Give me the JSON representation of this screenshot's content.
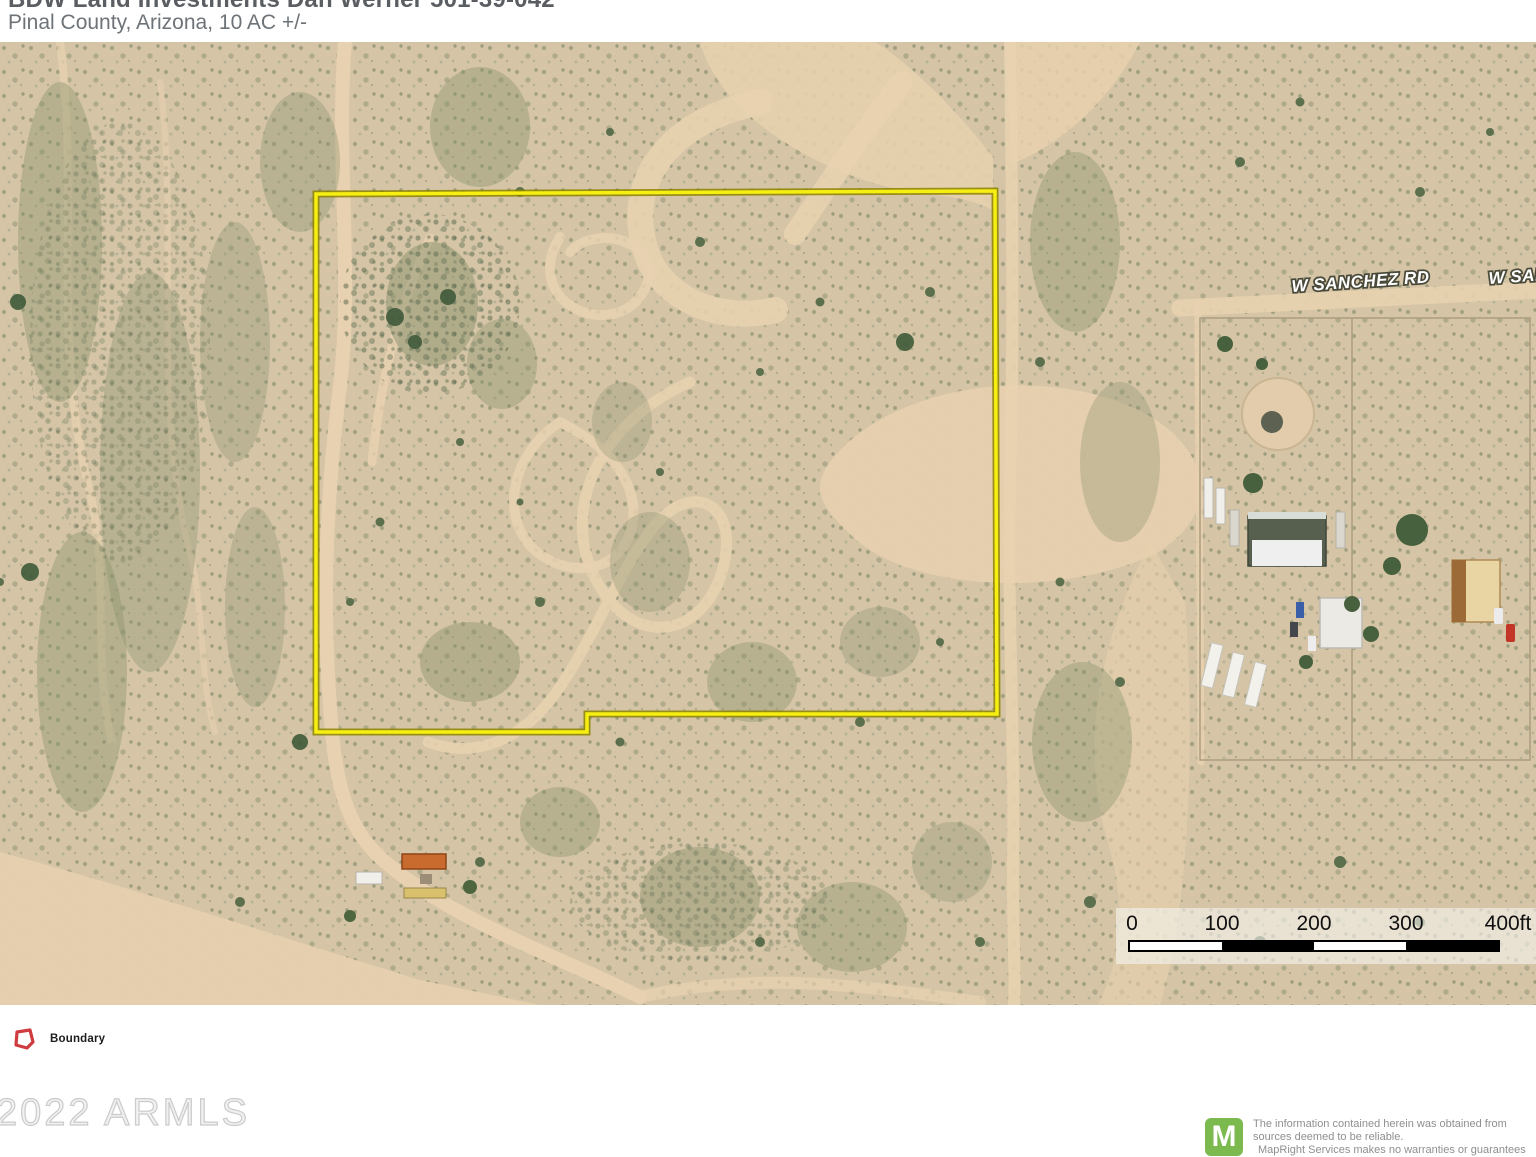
{
  "header": {
    "title_line1": "BDW Land Investments Dan Werner 501-39-042",
    "title_line2": "Pinal County, Arizona, 10 AC +/-"
  },
  "map": {
    "road_labels": [
      {
        "text": "W SANCHEZ RD"
      },
      {
        "text": "W SANCHEZ RD"
      }
    ],
    "boundary_color": "#f7ee12"
  },
  "scale_bar": {
    "ticks": [
      "0",
      "100",
      "200",
      "300",
      "400ft"
    ]
  },
  "legend": {
    "items": [
      {
        "label": "Boundary",
        "color": "#cf3b3f"
      }
    ]
  },
  "watermark": "2022 ARMLS",
  "footer": {
    "logo_letter": "M",
    "logo_color": "#7cb94f",
    "disclaimer_lines": [
      "The information contained herein was obtained from",
      "sources deemed to be reliable.",
      "MapRight Services makes no warranties or guarantees"
    ]
  }
}
